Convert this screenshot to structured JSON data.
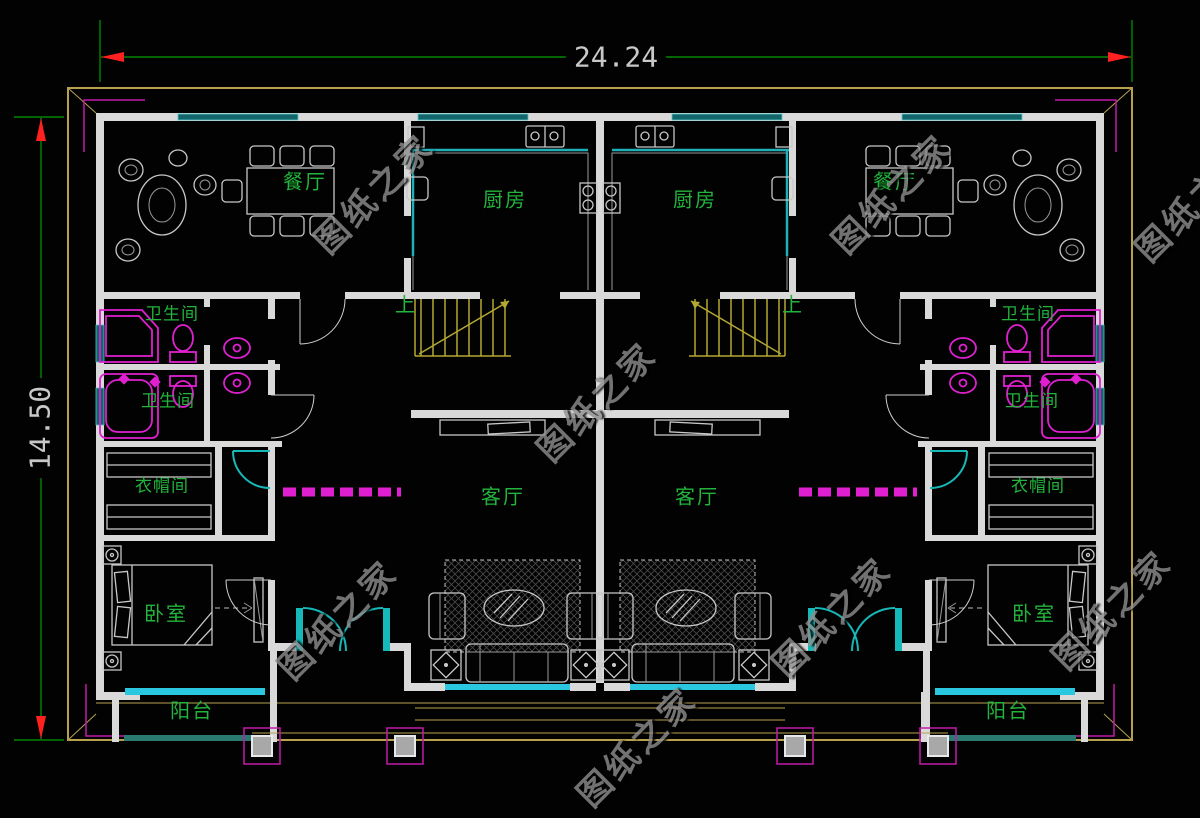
{
  "dimensions": {
    "horizontal": "24.24",
    "vertical": "14.50"
  },
  "watermark": {
    "text": "图纸之家"
  },
  "labels": {
    "dining": "餐厅",
    "kitchen": "厨房",
    "bathroom": "卫生间",
    "cloakroom": "衣帽间",
    "bedroom": "卧室",
    "living_room": "客厅",
    "balcony": "阳台",
    "stairs_up": "上"
  },
  "colors": {
    "background": "#020202",
    "wall": "#d9d9d9",
    "window_dark_teal": "#14646b",
    "window_bright_cyan": "#2ac8e0",
    "balcony_rail_teal": "#2a7a72",
    "roof_outline_olive": "#b8a14e",
    "dimension_line_green": "#00a000",
    "dimension_arrow_red": "#ff2020",
    "dimension_text_gray": "#c8c8c8",
    "room_label_green": "#22b43c",
    "fixture_magenta": "#e020d0",
    "corner_bracket_magenta": "#c21aa8",
    "stair_olive": "#b5a832",
    "furniture_gray": "#c8c8c8",
    "door_cyan": "#17b8b8",
    "watermark_gray": "#8f8f8f"
  }
}
